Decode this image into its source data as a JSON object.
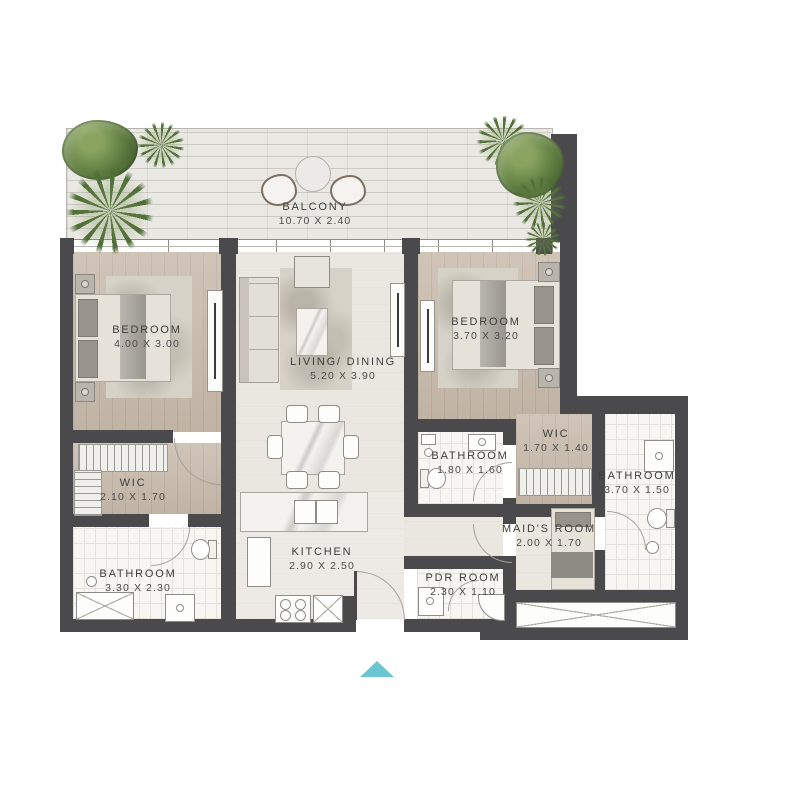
{
  "floor_plan": {
    "rooms": [
      {
        "id": "balcony",
        "name": "BALCONY",
        "dims": "10.70 X 2.40"
      },
      {
        "id": "bedroom-1",
        "name": "BEDROOM",
        "dims": "4.00 X 3.00"
      },
      {
        "id": "living",
        "name": "LIVING/ DINING",
        "dims": "5.20 X 3.90"
      },
      {
        "id": "bedroom-2",
        "name": "BEDROOM",
        "dims": "3.70 X 3.20"
      },
      {
        "id": "wic-1",
        "name": "WIC",
        "dims": "2.10 X 1.70"
      },
      {
        "id": "bathroom-1",
        "name": "BATHROOM",
        "dims": "3.30 X 2.30"
      },
      {
        "id": "kitchen",
        "name": "KITCHEN",
        "dims": "2.90 X 2.50"
      },
      {
        "id": "bathroom-2",
        "name": "BATHROOM",
        "dims": "1.80 X 1.60"
      },
      {
        "id": "wic-2",
        "name": "WIC",
        "dims": "1.70 X 1.40"
      },
      {
        "id": "bathroom-3",
        "name": "BATHROOM",
        "dims": "3.70 X 1.50"
      },
      {
        "id": "maids-room",
        "name": "MAID'S ROOM",
        "dims": "2.00 X 1.70"
      },
      {
        "id": "pdr-room",
        "name": "PDR ROOM",
        "dims": "2.30 X 1.10"
      }
    ],
    "icons": {
      "entrance_marker": "triangle-up"
    },
    "colors": {
      "wall": "#4a4a4d",
      "wood_floor": "#c8bbac",
      "light_floor": "#eae7e1",
      "tile_floor": "#f7f6f3",
      "balcony_floor": "#e9e8e3",
      "plant_green": "#5d7b40",
      "entrance_marker_teal": "#6cc5d3",
      "label_text": "#3d3d3d"
    }
  }
}
